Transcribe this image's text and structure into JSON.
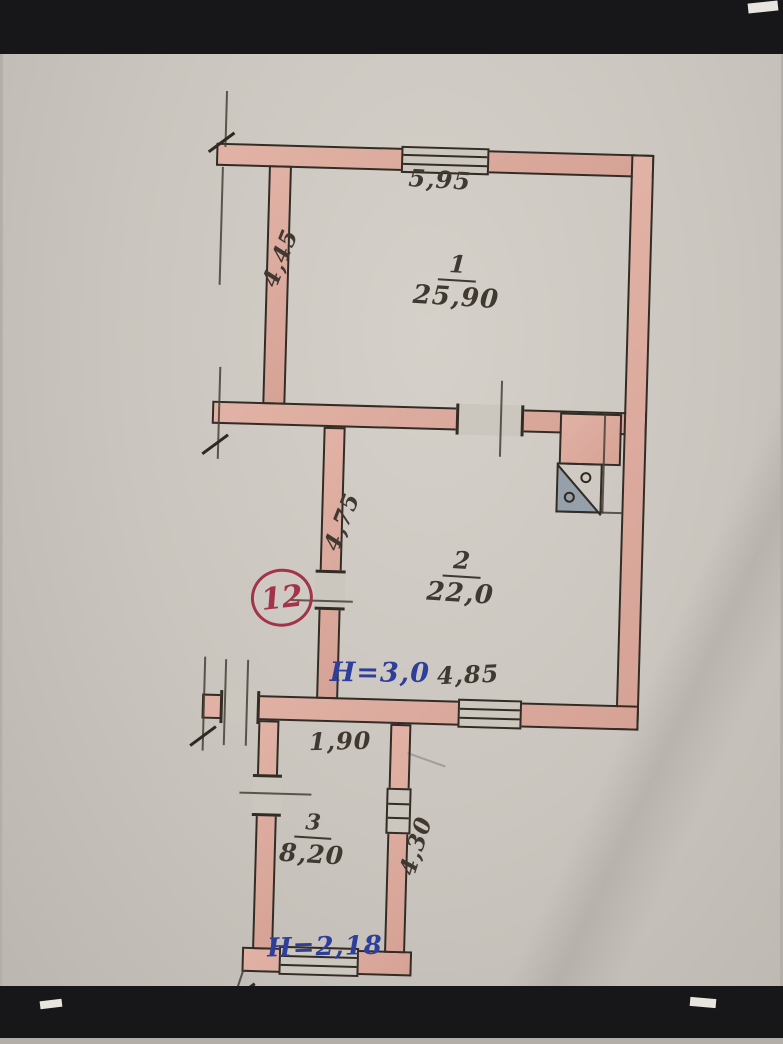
{
  "plan": {
    "apartment_number": "12",
    "rooms": [
      {
        "number": "1",
        "area": "25,90"
      },
      {
        "number": "2",
        "area": "22,0"
      },
      {
        "number": "3",
        "area": "8,20"
      }
    ],
    "dimensions": {
      "top_width": "5,95",
      "room1_left_height": "4,45",
      "room2_wall_height": "4,75",
      "room2_bottom_width": "4,85",
      "passage_width": "1,90",
      "room3_right_height": "4,30"
    },
    "ceiling_heights": {
      "room2": "H=3,0",
      "room3": "H=2,18"
    },
    "colors": {
      "wall_fill": "#dcab9f",
      "ink_line": "#332c25",
      "pencil": "#433d35",
      "blue_ink": "#2e3e9b",
      "red_ink": "#a23348",
      "paper": "#c9c4bd",
      "stove_gray": "#95a0ab"
    }
  }
}
